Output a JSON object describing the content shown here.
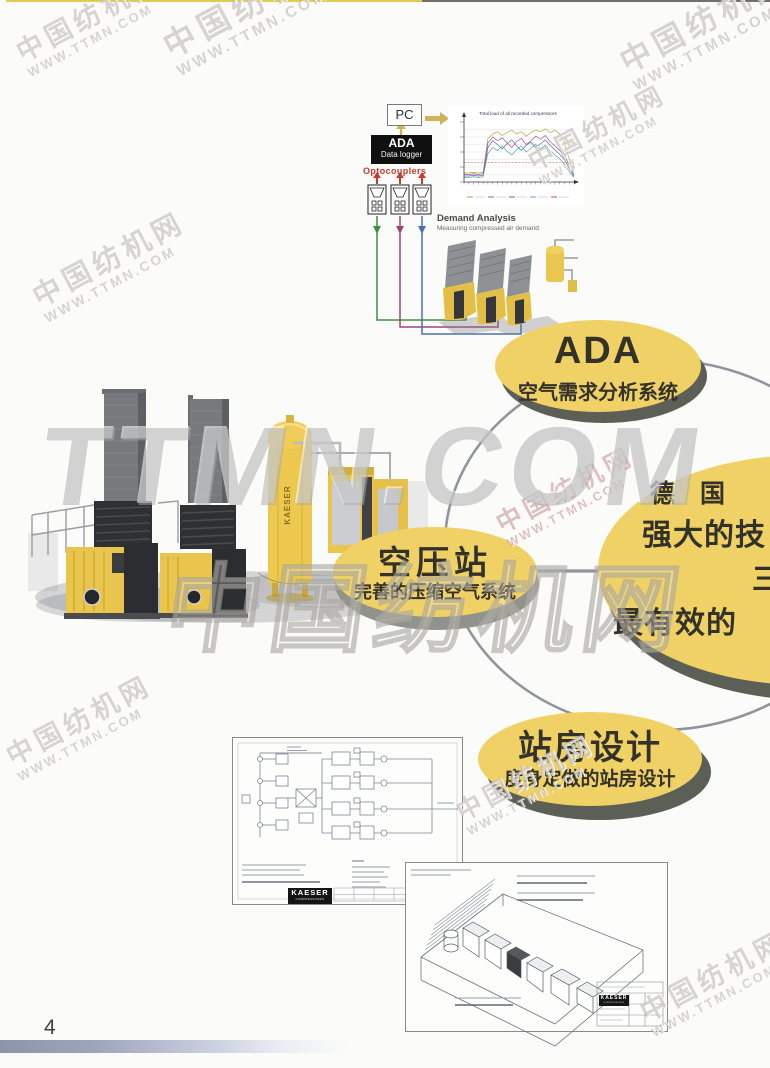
{
  "watermarks": {
    "line1": "中国纺机网",
    "line2": "WWW.TTMN.COM",
    "giant_latin": "TTMN.COM",
    "giant_cjk": "中国纺机网",
    "small": [
      {
        "left": 12,
        "top": 42,
        "s": 1.0
      },
      {
        "left": 158,
        "top": 34,
        "s": 1.2
      },
      {
        "left": 615,
        "top": 50,
        "s": 1.15
      },
      {
        "left": 524,
        "top": 152,
        "s": 0.95
      },
      {
        "left": 28,
        "top": 286,
        "s": 1.05
      },
      {
        "left": 492,
        "top": 514,
        "s": 0.95,
        "tint": "red"
      },
      {
        "left": 2,
        "top": 746,
        "s": 1.0
      },
      {
        "left": 452,
        "top": 802,
        "s": 0.95
      },
      {
        "left": 636,
        "top": 1002,
        "s": 1.0
      }
    ]
  },
  "diagram": {
    "pc_label": "PC",
    "logger_line1": "ADA",
    "logger_line2": "Data logger",
    "optocouplers_label": "Optocouplers",
    "demand_title": "Demand Analysis",
    "demand_subtitle": "Measuring compressed air demand"
  },
  "chart_data": {
    "type": "line",
    "title": "Total load of all recorded compressors",
    "xlabel": "",
    "ylabel": "",
    "ylim": [
      0,
      8
    ],
    "grid": true,
    "legend_position": "bottom",
    "x": [
      0,
      1,
      2,
      3,
      4,
      5,
      6,
      7,
      8,
      9,
      10,
      11,
      12,
      13,
      14,
      15,
      16,
      17,
      18,
      19,
      20,
      21,
      22,
      23
    ],
    "series": [
      {
        "name": "compressor-1",
        "color": "#b8a242",
        "values": [
          1.2,
          1.2,
          1.3,
          1.2,
          1.3,
          5.8,
          6.4,
          6.7,
          6.2,
          6.6,
          6.9,
          6.4,
          6.7,
          6.1,
          6.6,
          6.9,
          6.7,
          7.1,
          6.6,
          6.9,
          6.4,
          5.2,
          3.1,
          1.4
        ]
      },
      {
        "name": "compressor-2",
        "color": "#b05090",
        "values": [
          1.0,
          1.0,
          1.1,
          1.0,
          1.1,
          5.2,
          6.0,
          5.5,
          5.9,
          5.2,
          4.6,
          5.4,
          5.8,
          5.0,
          5.5,
          6.1,
          5.7,
          6.2,
          5.4,
          4.8,
          4.2,
          3.6,
          2.2,
          1.0
        ]
      },
      {
        "name": "compressor-3",
        "color": "#5070b8",
        "values": [
          0.8,
          0.8,
          0.9,
          0.8,
          0.9,
          4.6,
          5.5,
          5.0,
          4.4,
          5.1,
          5.6,
          4.8,
          4.2,
          4.9,
          5.3,
          4.6,
          5.1,
          5.6,
          4.9,
          4.3,
          3.7,
          3.0,
          1.8,
          0.8
        ]
      },
      {
        "name": "compressor-4",
        "color": "#58a8a0",
        "values": [
          0.6,
          0.6,
          0.7,
          0.6,
          0.7,
          3.8,
          4.6,
          4.2,
          4.8,
          4.1,
          3.6,
          4.3,
          4.8,
          4.0,
          4.5,
          5.0,
          4.4,
          4.9,
          4.2,
          3.6,
          3.1,
          2.4,
          1.4,
          0.6
        ]
      }
    ],
    "threshold": {
      "value": 2.6,
      "color": "#d04040"
    }
  },
  "network": {
    "ada": {
      "title": "ADA",
      "subtitle": "空气需求分析系统"
    },
    "station": {
      "title": "空压站",
      "subtitle": "完善的压缩空气系统"
    },
    "design": {
      "title": "站房设计",
      "subtitle": "度身定做的站房设计"
    },
    "hub": {
      "line1": "德 国",
      "line2": "强大的技",
      "line3": "三",
      "line4": "最有效的"
    }
  },
  "machines": {
    "tank_label": "KAESER"
  },
  "drawings": {
    "logo": "KAESER",
    "logo_sub": "KOMPRESSOREN"
  },
  "footer": {
    "page_number": "4"
  },
  "colors": {
    "accent_yellow": "#f0d165",
    "ellipse_shadow": "#5c5f56",
    "ring_gray": "#8f959b",
    "wire_green": "#3f8f3f",
    "wire_magenta": "#a0457f",
    "wire_blue": "#4a6fb5",
    "arrow_red": "#c9392e",
    "arrow_tan": "#cdb35a",
    "logo_black": "#151515"
  }
}
